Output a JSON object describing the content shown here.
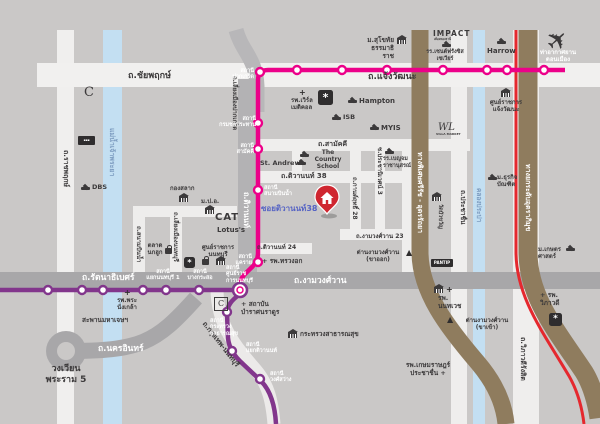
{
  "map_title": "โครงการ ซอยติวานนท์ 38 — แผนที่เส้นทาง (Nonthaburi / Chaengwattana area map)",
  "colors": {
    "background": "#cac8c7",
    "pink_line": "#ec0089",
    "purple_line": "#82368c",
    "red_line": "#e5282e",
    "expressway_brown": "#8f7c5e",
    "water_blue": "#c3dff2",
    "road_gray": "#a8a7a9",
    "road_white": "#f1f0ef",
    "pin_red": "#cf2630",
    "soi_text_blue": "#5563c4"
  },
  "icons": {
    "airplane": "✈",
    "toll_gate": "▲",
    "hospital_plus": "+",
    "ornament": "*"
  },
  "roads": {
    "chaiyaphruek": "ถ.ชัยพฤกษ์",
    "chaengwattana": "ถ.แจ้งวัฒนะ",
    "ratchaphruek": "ถ.ราชพฤกษ์",
    "chao_phraya": "แม่น้ำเจ้าพระยา",
    "liang_pakkret": "ถ.เลี่ยงเมืองปากเกร็ด",
    "tiwanon": "ถ.ติวานนท์",
    "samakkhi": "ถ.สามัคคี",
    "tiwanon38": "ถ.ติวานนท์ 38",
    "soi_tiwanon38": "ซอยติวานนท์38",
    "tiwanon24": "ถ.ติวานนท์ 24",
    "kan_rit28": "ถ.กานต์ฤทธิ์ 28",
    "prachaniwet3": "ซ.ประชานิเวศน์ 3",
    "ngamwongwan23": "ถ.งามวงศ์วาน 23",
    "rattanathibet": "ถ.รัตนาธิเบศร์",
    "ngamwongwan": "ถ.งามวงศ์วาน",
    "nakhon_in": "ถ.นครอินทร์",
    "krungthep_non": "ถ.กรุงเทพ-นนทบุรี",
    "sanambin_nam": "ถ.สนามบินน้ำ",
    "liang_non": "ถ.เลี่ยงเมืองนนทบุรี",
    "prachachuen": "ถ.ประชาชื่น",
    "khlong_prapa": "คลองประปา",
    "viphavadi": "ถ.วิภาวดีรังสิต",
    "srirat": "ทางพิเศษศรีรัช - อุดรรัถยา",
    "uttraphimuk": "ทางยกระดับอุตราภิมุข"
  },
  "stations": {
    "pakkret": "สถานี\nปากเกร็ด",
    "krom_chon": "สถานี\nกรมชลประทาน",
    "samakkhi": "สถานี\nสามัคคี",
    "sanambin_nam": "สถานี\nสนามบินน้ำ",
    "khae_rai": "สถานี\nแคราย",
    "govt_center_non": "สถานี\nศูนย์ราช\nการนนทบุรี",
    "yaek_non1": "สถานี\nแยกนนทบุรี 1",
    "bang_kraso": "สถานี\nบางกระสอ",
    "moph": "สถานี\nกระทรวง\nสาธารณสุข",
    "yaek_tiwanon": "สถานี\nแยกติวานนท์",
    "wong_sawang": "สถานี\nวงศ์สว่าง"
  },
  "places": {
    "sukhothai": "ม.สุโขทัย\nธรรมาธิราช",
    "impact": "IMPACT",
    "impact_sub": "เมืองทองธานี",
    "st_francis": "รร.เซนต์ฟรังซิส\nเซเวียร์",
    "harrow": "Harrow",
    "don_mueang": "ท่าอากาศยาน\nดอนเมือง",
    "world_medical": "รพ.เวิร์ล\nเมดิคอล",
    "hampton": "Hampton",
    "isb": "ISB",
    "myis": "MYIS",
    "govt_complex_cw": "ศูนย์ราชการ\nแจ้งวัฒนะ",
    "wl": "WL",
    "wl_sub": "VILLA MARKET",
    "country_school": "The Country\nSchool",
    "st_andrews": "St. Andrews",
    "benjama": "รร.เบญจม\nราชานุสรณ์",
    "dbs": "DBS",
    "c_mark": "C",
    "kong_salak": "กองสลาก",
    "mpo": "ม.ป.อ.",
    "owl_market": "ตลาด\nนกฮูก",
    "cat": "CAT",
    "lotus": "Lotus's",
    "govt_center_non": "ศูนย์ราชการ\nนนทบุรี",
    "chest_hospital": "+ รพ.ทรวงอก",
    "bamrat": "+ สถาบัน\nบำราศนราดูร",
    "moph": "กระทรวงสาธารณสุข",
    "phra_nangklao": "รพ.พระ\nนั่งเกล้า",
    "maha_chet_bridge": "สะพานมหาเจษฯ",
    "rama5_circle": "วงเวียน\nพระราม 5",
    "dan_ngam_out": "ด่านงามวงศ์วาน\n(ขาออก)",
    "dan_ngam_in": "ด่านงามวงศ์วาน\n(ขาเข้า)",
    "pantip": "PANTIP",
    "nonthavej": "รพ.\nนนทเวช",
    "kasemrad": "รพ.เกษมราษฎร์\nประชาชื่น +",
    "vibhavadi_hosp": "+ รพ.\nวิภาวดี",
    "kasetsart": "ม.เกษตร\nศาสตร์",
    "dhurakij": "ม.ธุรกิจ\nบัณฑิต",
    "wat_bua_khwan": "วัดบัวขวัญ"
  }
}
